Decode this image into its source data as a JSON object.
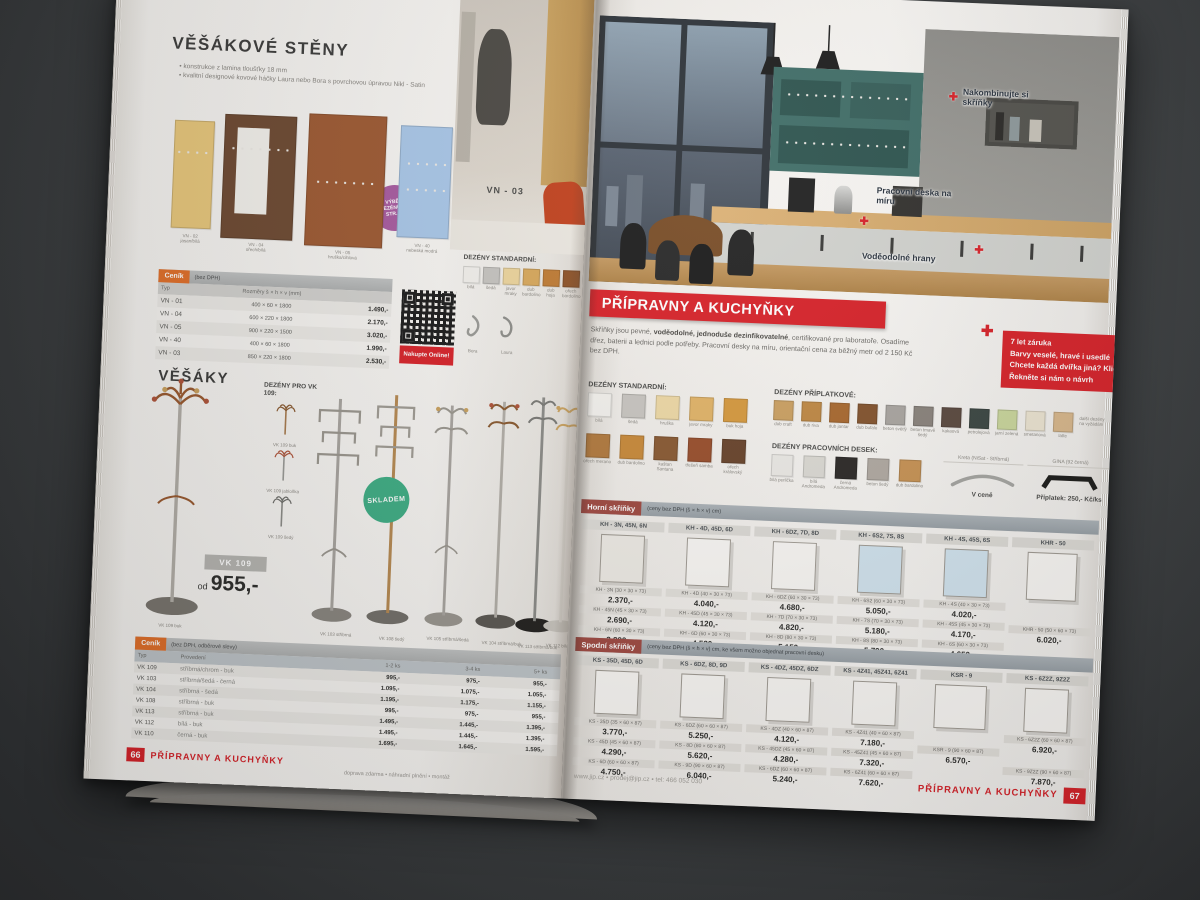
{
  "colors": {
    "accent_red": "#d8232a",
    "tag_orange": "#e2702a",
    "badge_purple": "#a85ba0",
    "badge_green": "#3fae85"
  },
  "left_page": {
    "hangwalls": {
      "title": "VĚŠÁKOVÉ STĚNY",
      "bullets": [
        "konstrukce z lamina tloušťky 18 mm",
        "kvalitní designové kovové háčky Laura nebo Bora s povrchovou úpravou Nikl - Satin"
      ],
      "panels": [
        {
          "code": "VN - 02",
          "finish": "jasan/bílá",
          "color": "#e9c87c"
        },
        {
          "code": "VN - 04",
          "finish": "ořech/bílá",
          "color": "#6e4a32"
        },
        {
          "code": "VN - 05",
          "finish": "hruška/cihlová",
          "color": "#9e5a33"
        },
        {
          "code": "VN - 40",
          "finish": "nebeská modrá",
          "color": "#a9c7e8"
        }
      ],
      "photo_label": "VN - 03",
      "badge": "VÝBĚR DEZÉNŮ NA STR. 33",
      "cenik": {
        "tag": "Ceník",
        "tag_note": "(bez DPH)",
        "col_typ": "Typ",
        "col_size": "Rozměry š × h × v (mm)",
        "rows": [
          {
            "typ": "VN - 01",
            "size": "400 × 60 × 1800",
            "price": "1.490,-"
          },
          {
            "typ": "VN - 04",
            "size": "600 × 220 × 1800",
            "price": "2.170,-"
          },
          {
            "typ": "VN - 05",
            "size": "900 × 220 × 1500",
            "price": "3.020,-"
          },
          {
            "typ": "VN - 40",
            "size": "400 × 60 × 1800",
            "price": "1.990,-"
          },
          {
            "typ": "VN - 03",
            "size": "850 × 220 × 1800",
            "price": "2.530,-"
          }
        ]
      },
      "qr_label": "Nakupte Online!",
      "dezeny": {
        "title": "DEZÉNY STANDARDNÍ:",
        "items": [
          {
            "label": "bílá",
            "color": "#f2f0ec"
          },
          {
            "label": "šedá",
            "color": "#c6c4c0"
          },
          {
            "label": "javor mraky",
            "color": "#ecd49c"
          },
          {
            "label": "dub bardolino",
            "color": "#d8a85c"
          },
          {
            "label": "dub hoja",
            "color": "#c07c35"
          },
          {
            "label": "ořech bardolino",
            "color": "#8f5429"
          }
        ]
      },
      "hooks": [
        {
          "label": "Bora"
        },
        {
          "label": "Laura"
        }
      ]
    },
    "stands": {
      "title": "VĚŠÁKY",
      "dezeny_title": "DEZÉNY PRO VK 109:",
      "variants": [
        "VK 109 buk",
        "VK 109 jabloňka",
        "VK 109 šedý"
      ],
      "model_badge": "VK 109",
      "price_prefix": "od",
      "price": "955,-",
      "stock_badge": "SKLADEM",
      "stand_labels": [
        "VK 109 buk",
        "VK 103 stříbrná",
        "VK 108 šedý",
        "VK 105 stříbrná/šedá",
        "VK 104 stříbrná/buk",
        "VK 113 stříbrná/buk",
        "VK 112 bílá/buk"
      ],
      "cenik": {
        "tag": "Ceník",
        "tag_note": "(bez DPH, odběrové slevy)",
        "cols": [
          "Typ",
          "Provedení",
          "1-2 ks",
          "3-4 ks",
          "5+ ks"
        ],
        "rows": [
          {
            "typ": "VK 109",
            "finish": "stříbrná/chrom - buk",
            "p1": "995,-",
            "p2": "975,-",
            "p3": "955,-"
          },
          {
            "typ": "VK 103",
            "finish": "stříbrná/šedá - černá",
            "p1": "1.095,-",
            "p2": "1.075,-",
            "p3": "1.055,-"
          },
          {
            "typ": "VK 104",
            "finish": "stříbrná - šedá",
            "p1": "1.195,-",
            "p2": "1.175,-",
            "p3": "1.155,-"
          },
          {
            "typ": "VK 108",
            "finish": "stříbrná - buk",
            "p1": "995,-",
            "p2": "975,-",
            "p3": "955,-"
          },
          {
            "typ": "VK 113",
            "finish": "stříbrná - buk",
            "p1": "1.495,-",
            "p2": "1.445,-",
            "p3": "1.395,-"
          },
          {
            "typ": "VK 112",
            "finish": "bílá - buk",
            "p1": "1.495,-",
            "p2": "1.445,-",
            "p3": "1.395,-"
          },
          {
            "typ": "VK 110",
            "finish": "černá - buk",
            "p1": "1.695,-",
            "p2": "1.645,-",
            "p3": "1.595,-"
          }
        ]
      }
    },
    "footer": {
      "page": "66",
      "section": "PŘÍPRAVNY A KUCHYŇKY",
      "note": "doprava zdarma  •  náhradní plnění  •  montáž"
    }
  },
  "right_page": {
    "photo": {
      "annotations": [
        "Nakombinujte si skříňky",
        "Pracovní deska na míru",
        "Voděodolné hrany"
      ]
    },
    "headline": "PŘÍPRAVNY A KUCHYŇKY",
    "tips": [
      "7 let záruka",
      "Barvy veselé, hravé i usedlé",
      "Chcete každá dvířka jiná? Klidně!",
      "Řekněte si nám o návrh"
    ],
    "intro": {
      "p1": "Skříňky jsou pevné, ",
      "b1": "voděodolné, jednoduše dezinfikovatelné",
      "p2": ", certifikované pro laboratoře. Osadíme dřez, baterii a lednici podle potřeby. Pracovní desky na míru, orientační cena za běžný metr od 2 150 Kč bez DPH."
    },
    "dezeny_standard": {
      "title": "DEZÉNY STANDARDNÍ:",
      "items": [
        {
          "label": "bílá",
          "color": "#f3f1ed"
        },
        {
          "label": "šedá",
          "color": "#c9c6c1"
        },
        {
          "label": "hruška",
          "color": "#eed9a6"
        },
        {
          "label": "javor mraky",
          "color": "#e2b468"
        },
        {
          "label": "buk hoja",
          "color": "#d79a3f"
        },
        {
          "label": "ořech merano",
          "color": "#b27a3e"
        },
        {
          "label": "dub bardolino",
          "color": "#c98a3a"
        },
        {
          "label": "kaštan Santana",
          "color": "#8a5a33"
        },
        {
          "label": "třešeň samba",
          "color": "#9a4f2d"
        },
        {
          "label": "ořech královský",
          "color": "#6a452c"
        }
      ]
    },
    "dezeny_extra": {
      "title": "DEZÉNY PŘÍPLATKOVÉ:",
      "items": [
        {
          "label": "dub craft",
          "color": "#cda263"
        },
        {
          "label": "dub riva",
          "color": "#c18a45"
        },
        {
          "label": "dub jantar",
          "color": "#aa6a30"
        },
        {
          "label": "dub bufalo",
          "color": "#85552f"
        },
        {
          "label": "beton světlý",
          "color": "#aba7a2"
        },
        {
          "label": "beton tmavě šedý",
          "color": "#8b847d"
        },
        {
          "label": "kakaová",
          "color": "#5c4a40"
        },
        {
          "label": "petrolejová",
          "color": "#3c4743"
        },
        {
          "label": "jarní zelená",
          "color": "#cbd79d"
        },
        {
          "label": "smetanová",
          "color": "#ede5d2"
        },
        {
          "label": "latte",
          "color": "#d9b88c"
        }
      ],
      "note": "další dezény na vyžádání"
    },
    "dezeny_desky": {
      "title": "DEZÉNY PRACOVNÍCH DESEK:",
      "items": [
        {
          "label": "bílá perlička",
          "color": "#edebe7"
        },
        {
          "label": "bílá Andromeda",
          "color": "#dddbd5"
        },
        {
          "label": "černá Andromeda",
          "color": "#2d2a28"
        },
        {
          "label": "beton šedý",
          "color": "#b2aba3"
        },
        {
          "label": "dub bardolino",
          "color": "#c99455"
        }
      ]
    },
    "handles": {
      "h1_name": "Kreta (NiSat - Stříbrná)",
      "h1_note": "V ceně",
      "h2_name": "GINA (92 černá)",
      "h2_note": "Příplatek: 250,- Kč/ks"
    },
    "upper": {
      "title": "Horní skříňky",
      "subtitle": "(ceny bez DPH (š × h × v) cm)",
      "columns": [
        {
          "header": "KH - 3N, 45N, 6N",
          "items": [
            {
              "model": "KH - 3N (30 × 30 × 73)",
              "price": "2.370,-"
            },
            {
              "model": "KH - 45N (45 × 30 × 73)",
              "price": "2.690,-"
            },
            {
              "model": "KH - 6N (60 × 30 × 73)",
              "price": "2.880,-"
            }
          ]
        },
        {
          "header": "KH - 4D, 45D, 6D",
          "items": [
            {
              "model": "KH - 4D (40 × 30 × 73)",
              "price": "4.040,-"
            },
            {
              "model": "KH - 45D (45 × 30 × 73)",
              "price": "4.120,-"
            },
            {
              "model": "KH - 6D (60 × 30 × 73)",
              "price": "4.520,-"
            }
          ]
        },
        {
          "header": "KH - 6DZ, 7D, 8D",
          "items": [
            {
              "model": "KH - 6DZ (60 × 30 × 73)",
              "price": "4.680,-"
            },
            {
              "model": "KH - 7D (70 × 30 × 73)",
              "price": "4.820,-"
            },
            {
              "model": "KH - 8D (80 × 30 × 73)",
              "price": "5.150,-"
            }
          ]
        },
        {
          "header": "KH - 6S2, 7S, 8S",
          "items": [
            {
              "model": "KH - 6S2 (60 × 30 × 73)",
              "price": "5.050,-"
            },
            {
              "model": "KH - 7S (70 × 30 × 73)",
              "price": "5.180,-"
            },
            {
              "model": "KH - 8S (80 × 30 × 73)",
              "price": "5.790,-"
            }
          ]
        },
        {
          "header": "KH - 4S, 45S, 6S",
          "items": [
            {
              "model": "KH - 4S (40 × 30 × 73)",
              "price": "4.020,-"
            },
            {
              "model": "KH - 45S (45 × 30 × 73)",
              "price": "4.170,-"
            },
            {
              "model": "KH - 6S (60 × 30 × 73)",
              "price": "4.650,-"
            }
          ]
        },
        {
          "header": "KHR - 50",
          "items": [
            {
              "model": "KHR - 50 (50 × 60 × 73)",
              "price": "6.020,-"
            }
          ]
        }
      ]
    },
    "lower": {
      "title": "Spodní skříňky",
      "subtitle": "(ceny bez DPH (š × h × v) cm, ke všem možno objednat pracovní desku)",
      "columns": [
        {
          "header": "KS - 35D, 45D, 6D",
          "items": [
            {
              "model": "KS - 35D (35 × 60 × 87)",
              "price": "3.770,-"
            },
            {
              "model": "KS - 45D (45 × 60 × 87)",
              "price": "4.290,-"
            },
            {
              "model": "KS - 6D (60 × 60 × 87)",
              "price": "4.750,-"
            }
          ]
        },
        {
          "header": "KS - 6DZ, 8D, 9D",
          "items": [
            {
              "model": "KS - 6DZ (60 × 60 × 87)",
              "price": "5.250,-"
            },
            {
              "model": "KS - 8D (80 × 60 × 87)",
              "price": "5.620,-"
            },
            {
              "model": "KS - 9D (90 × 60 × 87)",
              "price": "6.040,-"
            }
          ]
        },
        {
          "header": "KS - 4DZ, 45DZ, 6DZ",
          "items": [
            {
              "model": "KS - 4DZ (40 × 60 × 87)",
              "price": "4.120,-"
            },
            {
              "model": "KS - 45DZ (45 × 60 × 87)",
              "price": "4.280,-"
            },
            {
              "model": "KS - 6DZ (60 × 60 × 87)",
              "price": "5.240,-"
            }
          ]
        },
        {
          "header": "KS - 4Z41, 45Z41, 6Z41",
          "items": [
            {
              "model": "KS - 4Z41 (40 × 60 × 87)",
              "price": "7.180,-"
            },
            {
              "model": "KS - 45Z41 (45 × 60 × 87)",
              "price": "7.320,-"
            },
            {
              "model": "KS - 6Z41 (60 × 60 × 87)",
              "price": "7.620,-"
            }
          ]
        },
        {
          "header": "KSR - 9",
          "items": [
            {
              "model": "KSR - 9 (90 × 60 × 87)",
              "price": "6.570,-"
            }
          ]
        },
        {
          "header": "KS - 6Z2Z, 9Z2Z",
          "items": [
            {
              "model": "KS - 6Z2Z (60 × 60 × 87)",
              "price": "6.920,-"
            },
            {
              "model": "KS - 9Z2Z (90 × 60 × 87)",
              "price": "7.870,-"
            }
          ]
        }
      ]
    },
    "footer": {
      "contacts": "www.jip.cz   •   prodej@jip.cz   •   tel: 466 052 030",
      "section": "PŘÍPRAVNY A KUCHYŇKY",
      "page": "67"
    }
  }
}
